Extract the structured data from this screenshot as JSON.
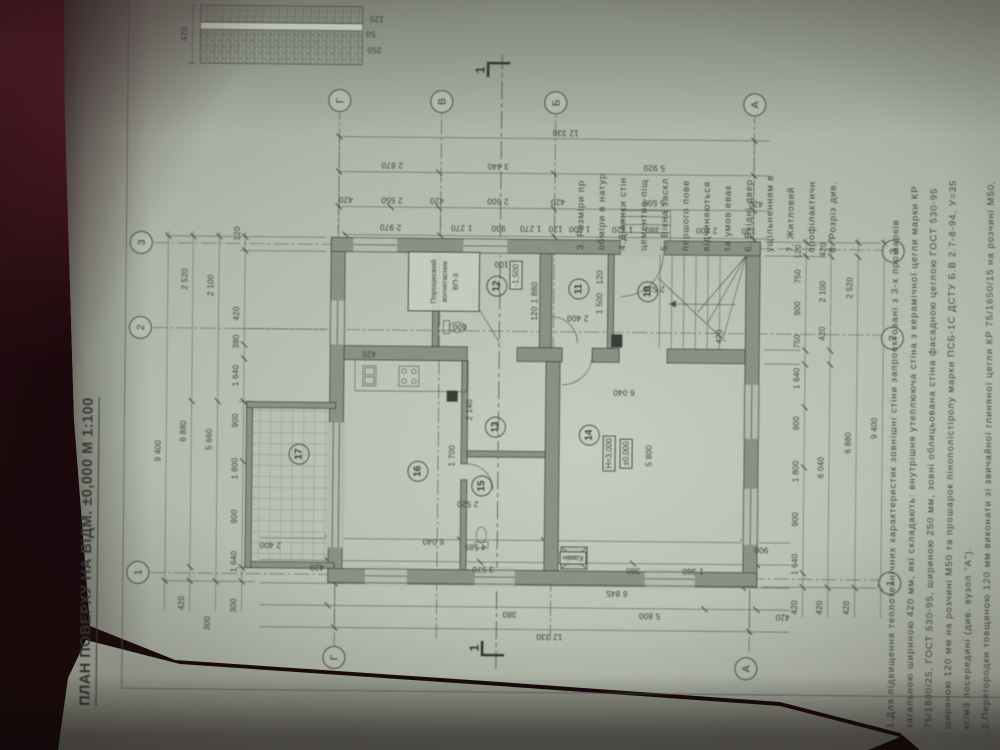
{
  "palette": {
    "paper": "#b3baac",
    "ink": "#3c413c",
    "wall_fill": "#8b9085",
    "cover": "#4a1722",
    "underpage": "#d4d9ca"
  },
  "title": "ПЛАН ПОВЕРХУ НА ВІДМ. ±0,000  М 1:100",
  "plan": {
    "axis_circles": [
      {
        "t": "1",
        "x": 178,
        "y": 133
      },
      {
        "t": "2",
        "x": 423,
        "y": 133
      },
      {
        "t": "3",
        "x": 508,
        "y": 133
      },
      {
        "t": "1",
        "x": 175,
        "y": 885
      },
      {
        "t": "2",
        "x": 420,
        "y": 885
      },
      {
        "t": "3",
        "x": 507,
        "y": 885
      },
      {
        "t": "Г",
        "x": 95,
        "y": 330
      },
      {
        "t": "А",
        "x": 88,
        "y": 742
      },
      {
        "t": "Г",
        "x": 652,
        "y": 330
      },
      {
        "t": "В",
        "x": 652,
        "y": 432
      },
      {
        "t": "Б",
        "x": 652,
        "y": 546
      },
      {
        "t": "А",
        "x": 652,
        "y": 745
      }
    ],
    "room_circles": [
      {
        "t": "17",
        "x": 298,
        "y": 293
      },
      {
        "t": "16",
        "x": 282,
        "y": 412
      },
      {
        "t": "15",
        "x": 268,
        "y": 476
      },
      {
        "t": "13",
        "x": 327,
        "y": 489
      },
      {
        "t": "14",
        "x": 320,
        "y": 583
      },
      {
        "t": "12",
        "x": 468,
        "y": 489
      },
      {
        "t": "11",
        "x": 466,
        "y": 571
      },
      {
        "t": "10",
        "x": 464,
        "y": 640
      }
    ],
    "dim_labels": [
      {
        "t": "9 400",
        "x": 300,
        "y": 152
      },
      {
        "t": "420",
        "x": 148,
        "y": 177
      },
      {
        "t": "6 880",
        "x": 320,
        "y": 177
      },
      {
        "t": "2 520",
        "x": 472,
        "y": 177
      },
      {
        "t": "300",
        "x": 128,
        "y": 203
      },
      {
        "t": "5 660",
        "x": 312,
        "y": 203
      },
      {
        "t": "2 100",
        "x": 466,
        "y": 203
      },
      {
        "t": "300",
        "x": 146,
        "y": 229
      },
      {
        "t": "1 640",
        "x": 190,
        "y": 229
      },
      {
        "t": "900",
        "x": 235,
        "y": 229
      },
      {
        "t": "1 800",
        "x": 283,
        "y": 229
      },
      {
        "t": "900",
        "x": 331,
        "y": 229
      },
      {
        "t": "1 640",
        "x": 376,
        "y": 229
      },
      {
        "t": "380",
        "x": 410,
        "y": 229
      },
      {
        "t": "420",
        "x": 438,
        "y": 229
      },
      {
        "t": "120",
        "x": 518,
        "y": 229
      },
      {
        "t": "420",
        "x": 150,
        "y": 790
      },
      {
        "t": "1 640",
        "x": 193,
        "y": 790
      },
      {
        "t": "900",
        "x": 238,
        "y": 790
      },
      {
        "t": "1 800",
        "x": 286,
        "y": 790
      },
      {
        "t": "900",
        "x": 334,
        "y": 790
      },
      {
        "t": "1 640",
        "x": 379,
        "y": 790
      },
      {
        "t": "750",
        "x": 416,
        "y": 790
      },
      {
        "t": "900",
        "x": 449,
        "y": 790
      },
      {
        "t": "750",
        "x": 481,
        "y": 790
      },
      {
        "t": "120",
        "x": 506,
        "y": 790
      },
      {
        "t": "420",
        "x": 150,
        "y": 815
      },
      {
        "t": "6 040",
        "x": 290,
        "y": 815
      },
      {
        "t": "420",
        "x": 424,
        "y": 815
      },
      {
        "t": "2 100",
        "x": 466,
        "y": 815
      },
      {
        "t": "420",
        "x": 508,
        "y": 815
      },
      {
        "t": "420",
        "x": 150,
        "y": 842
      },
      {
        "t": "6 880",
        "x": 315,
        "y": 842
      },
      {
        "t": "2 520",
        "x": 470,
        "y": 842
      },
      {
        "t": "9 400",
        "x": 330,
        "y": 868
      },
      {
        "t": "2 400",
        "x": 207,
        "y": 265,
        "o": "v"
      },
      {
        "t": "4 585",
        "x": 207,
        "y": 470,
        "o": "v"
      },
      {
        "t": "900",
        "x": 207,
        "y": 756,
        "o": "v"
      },
      {
        "t": "420",
        "x": 185,
        "y": 312,
        "o": "v"
      },
      {
        "t": "3 570",
        "x": 185,
        "y": 478,
        "o": "v"
      },
      {
        "t": "380",
        "x": 185,
        "y": 628,
        "o": "v"
      },
      {
        "t": "1 380",
        "x": 185,
        "y": 688,
        "o": "v"
      },
      {
        "t": "6 845",
        "x": 162,
        "y": 612,
        "o": "v"
      },
      {
        "t": "380",
        "x": 140,
        "y": 505,
        "o": "v"
      },
      {
        "t": "5 800",
        "x": 140,
        "y": 645,
        "o": "v"
      },
      {
        "t": "420",
        "x": 140,
        "y": 778,
        "o": "v"
      },
      {
        "t": "12 330",
        "x": 118,
        "y": 545,
        "o": "v"
      },
      {
        "t": "2 970",
        "x": 526,
        "y": 382,
        "o": "v"
      },
      {
        "t": "1 270",
        "x": 526,
        "y": 453,
        "o": "v"
      },
      {
        "t": "900",
        "x": 526,
        "y": 490,
        "o": "v"
      },
      {
        "t": "1 270",
        "x": 526,
        "y": 522,
        "o": "v"
      },
      {
        "t": "120",
        "x": 526,
        "y": 547,
        "o": "v"
      },
      {
        "t": "1 500",
        "x": 526,
        "y": 571,
        "o": "v"
      },
      {
        "t": "1 120",
        "x": 526,
        "y": 614,
        "o": "v"
      },
      {
        "t": "380",
        "x": 526,
        "y": 644,
        "o": "v"
      },
      {
        "t": "2 800",
        "x": 526,
        "y": 698,
        "o": "v"
      },
      {
        "t": "120",
        "x": 526,
        "y": 740,
        "o": "v"
      },
      {
        "t": "420",
        "x": 553,
        "y": 337,
        "o": "v"
      },
      {
        "t": "2 550",
        "x": 553,
        "y": 383,
        "o": "v"
      },
      {
        "t": "420",
        "x": 553,
        "y": 428,
        "o": "v"
      },
      {
        "t": "2 600",
        "x": 553,
        "y": 489,
        "o": "v"
      },
      {
        "t": "420",
        "x": 553,
        "y": 549,
        "o": "v"
      },
      {
        "t": "5 500",
        "x": 553,
        "y": 645,
        "o": "v"
      },
      {
        "t": "420",
        "x": 553,
        "y": 747,
        "o": "v"
      },
      {
        "t": "2 870",
        "x": 588,
        "y": 383,
        "o": "v"
      },
      {
        "t": "3 440",
        "x": 588,
        "y": 489,
        "o": "v"
      },
      {
        "t": "5 920",
        "x": 588,
        "y": 645,
        "o": "v"
      },
      {
        "t": "12 330",
        "x": 622,
        "y": 556,
        "o": "v"
      },
      {
        "t": "6 040",
        "x": 212,
        "y": 428,
        "o": "v"
      },
      {
        "t": "1 700",
        "x": 298,
        "y": 446
      },
      {
        "t": "2 140",
        "x": 344,
        "y": 463
      },
      {
        "t": "2 520",
        "x": 250,
        "y": 462,
        "o": "v"
      },
      {
        "t": "5 800",
        "x": 300,
        "y": 643
      },
      {
        "t": "6 040",
        "x": 363,
        "y": 617,
        "o": "v"
      },
      {
        "t": "600",
        "x": 427,
        "y": 452,
        "o": "v"
      },
      {
        "t": "1 880",
        "x": 462,
        "y": 527
      },
      {
        "t": "120",
        "x": 441,
        "y": 527
      },
      {
        "t": "2 100",
        "x": 490,
        "y": 497,
        "o": "v"
      },
      {
        "t": "1 600",
        "x": 455,
        "y": 467
      },
      {
        "t": "2 400",
        "x": 437,
        "y": 570,
        "o": "v"
      },
      {
        "t": "1 500",
        "x": 452,
        "y": 592
      },
      {
        "t": "120",
        "x": 478,
        "y": 592
      },
      {
        "t": "2 520",
        "x": 467,
        "y": 646,
        "o": "v"
      },
      {
        "t": "420",
        "x": 399,
        "y": 362,
        "o": "v"
      },
      {
        "t": "420",
        "x": 420,
        "y": 712
      }
    ],
    "boxed_labels": [
      {
        "t": "H=3,000",
        "x": 302,
        "y": 603
      },
      {
        "t": "±0,000",
        "x": 302,
        "y": 620
      },
      {
        "t": "-1,500",
        "x": 479,
        "y": 508
      },
      {
        "t": "Камін",
        "x": 197,
        "y": 568,
        "o": "v"
      }
    ],
    "section_marks": [
      {
        "t": "1",
        "x": 106,
        "y": 470
      },
      {
        "t": "1",
        "x": 684,
        "y": 470
      }
    ],
    "detail_labels": [
      {
        "t": "420",
        "x": 717,
        "y": 174
      },
      {
        "t": "250",
        "x": 703,
        "y": 364,
        "o": "v"
      },
      {
        "t": "50",
        "x": 719,
        "y": 360,
        "o": "v"
      },
      {
        "t": "120",
        "x": 734,
        "y": 366,
        "o": "v"
      }
    ],
    "extinguisher_lines": [
      "Порошковий",
      "вогнегасник",
      "ВП-3"
    ]
  },
  "notes_right_lines": [
    "3. Розміри пр",
    "обміри в натур",
    "4.Ділянки стін",
    "цементно-піщ",
    "5. Вікна заскл",
    "першого пове",
    "відчиняються",
    "та умов евак",
    "6. Вхідні двер",
    "ущільненням в",
    "7. Житловий",
    "профілактичн",
    "8. Розріз див."
  ],
  "notes_bottom_lines": [
    "1.Для підвищення теплотехнічних характеристик зовнішні стіни запроектовані з 3-х прошарків",
    "загальною шириною 420 мм, які складають: внутрішня утеплююча стіна з керамічної цегли марки КР",
    "75/1800/25, ГОСТ 530-95, шириною 250 мм, зовні облицьована стіна фасадною цеглою ГОСТ 530-95",
    "шириною 120 мм на розчині М50 та прошарок пінополістіролу марки ПСБ-1С ДСТУ Б.В 2.7-8-94, У=35",
    "кг/м3 посередині (див. вузол \"А\").",
    "2.Перегородки товщиною 120 мм виконати зі звичайної глиняної цегли КР 75/1650/15 на розчині М50,"
  ]
}
